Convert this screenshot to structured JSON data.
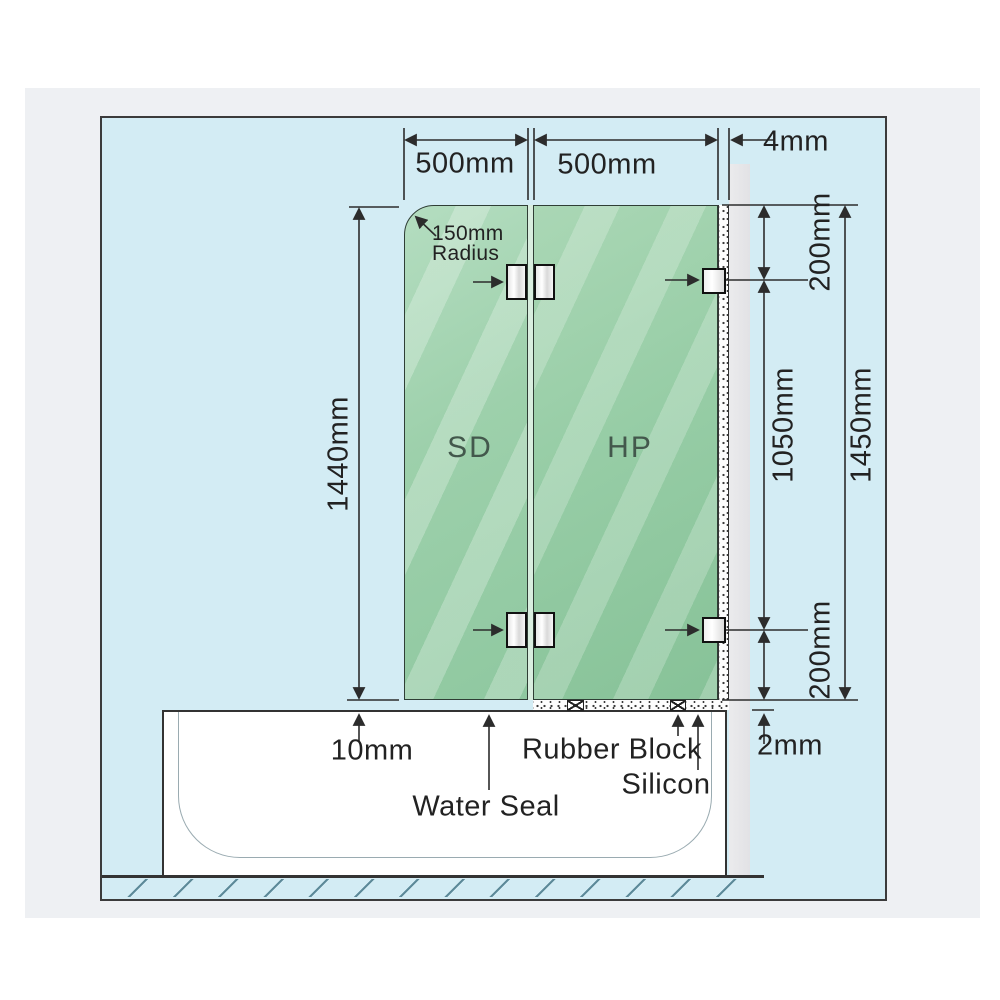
{
  "dimensions": {
    "sd_panel_width": "500mm",
    "hp_panel_width": "500mm",
    "wall_gap": "4mm",
    "corner_radius_line1": "150mm",
    "corner_radius_line2": "Radius",
    "sd_panel_height": "1440mm",
    "hp_panel_height": "1450mm",
    "top_bracket_offset": "200mm",
    "bracket_spacing": "1050mm",
    "bottom_bracket_offset": "200mm",
    "bath_gap": "10mm",
    "seal_thickness": "2mm"
  },
  "panels": {
    "shower_door": "SD",
    "fixed_panel": "HP"
  },
  "annotations": {
    "water_seal": "Water Seal",
    "rubber_block": "Rubber Block",
    "silicon": "Silicon"
  },
  "colors": {
    "diagram_background": "#d3ecf4",
    "glass_green": "#9cd0ab",
    "wall_gray": "#e7e7e9",
    "line_dark": "#2c2c2c",
    "page_panel": "#eef0f3"
  }
}
